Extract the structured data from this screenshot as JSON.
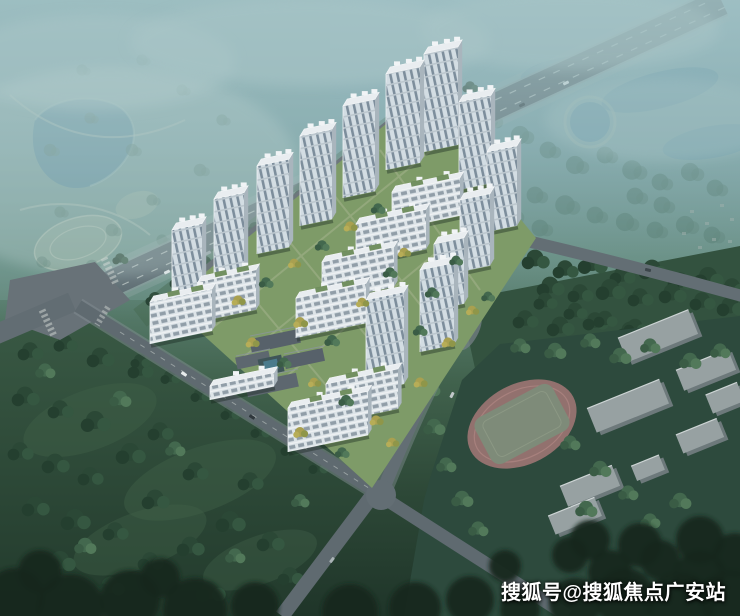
{
  "image": {
    "description": "Aerial daytime rendering of a residential compound: rows of white high-rise towers and mid-rise slabs around green courtyards, bounded by tree-lined roads, a large wooded field, a hazy lake park in the distance and a school campus with a running track"
  },
  "watermark": {
    "text": "搜狐号@搜狐焦点广安站",
    "color": "#ffffff"
  },
  "palette": {
    "haze_sky": "#8fb2b6",
    "distant_teal": "#7da6ab",
    "lake": "#56869b",
    "forest": "#3c5c4a",
    "field": "#2d4936",
    "dark_trees": "#16271d",
    "road": "#5f6a71",
    "building_facade": "#d6dee3",
    "building_side": "#a9b5bd",
    "roof": "#e9edf0",
    "accent_tree_yellow": "#b0a752",
    "track_ring": "#9b7472",
    "track_infield": "#7e8b79"
  }
}
